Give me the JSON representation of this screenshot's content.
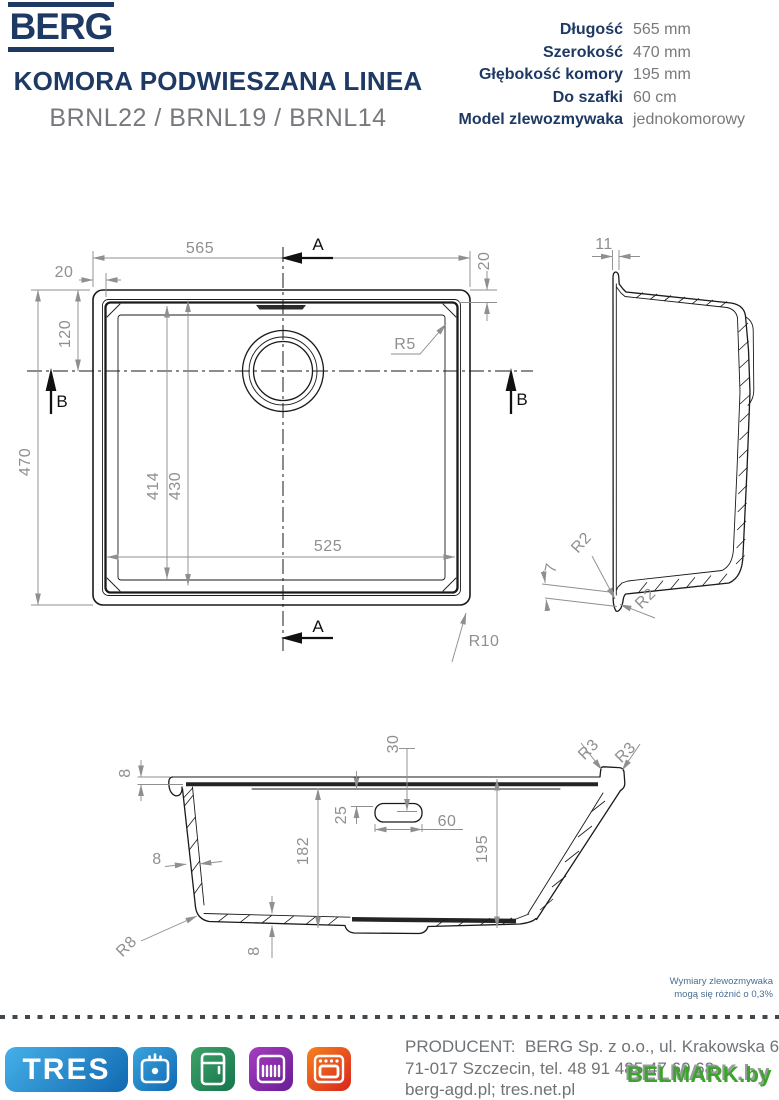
{
  "header": {
    "brand": "BERG",
    "title": "KOMORA PODWIESZANA LINEA",
    "models": "BRNL22 / BRNL19 / BRNL14",
    "specs": [
      {
        "label": "Długość",
        "value": "565 mm"
      },
      {
        "label": "Szerokość",
        "value": "470 mm"
      },
      {
        "label": "Głębokość komory",
        "value": "195 mm"
      },
      {
        "label": "Do szafki",
        "value": "60 cm"
      },
      {
        "label": "Model zlewozmywaka",
        "value": "jednokomorowy"
      }
    ]
  },
  "drawing": {
    "top_view": {
      "dim_length": "565",
      "dim_rim_left": "20",
      "dim_rim_right": "20",
      "dim_drain": "120",
      "dim_width": "470",
      "dim_inner_a": "414",
      "dim_inner_b": "430",
      "dim_inner_width": "525",
      "radius_bowl": "R5",
      "radius_outer": "R10",
      "section_a": "A",
      "section_b": "B"
    },
    "side_view": {
      "dim_top": "11",
      "dim_foot": "7",
      "radius_top": "R2",
      "radius_bottom": "R2"
    },
    "cross_section": {
      "dim_rim": "8",
      "dim_wall": "8",
      "dim_inner_depth": "182",
      "dim_overflow_top": "25",
      "dim_overflow_pos": "30",
      "dim_overflow_width": "60",
      "dim_depth": "195",
      "dim_bottom": "8",
      "radius_corner": "R8",
      "radius_edge_a": "R3",
      "radius_edge_b": "R3"
    },
    "note_line1": "Wymiary zlewozmywaka",
    "note_line2": "mogą się różnić o 0,3%"
  },
  "footer": {
    "tres": "TRES",
    "icons": [
      "sink-icon",
      "fridge-icon",
      "dishwasher-icon",
      "oven-icon"
    ],
    "producer_line1": "PRODUCENT:  BERG Sp. z o.o., ul. Krakowska 61B,",
    "producer_line2": "71-017 Szczecin, tel. 48 91 485 47 60 68",
    "producer_line3": "berg-agd.pl; tres.net.pl",
    "watermark": "BELMARK.by"
  },
  "colors": {
    "navy": "#1e3a64",
    "text-gray": "#77797c",
    "producer-gray": "#6f7377",
    "dim-gray": "#8f8f8f",
    "line-black": "#1a1a1a",
    "note-blue": "#4a6d94",
    "tres-blue-1": "#45b0e8",
    "tres-blue-2": "#1168b0",
    "sink-blue-1": "#3ba4de",
    "sink-blue-2": "#1069b2",
    "fridge-green-1": "#3fa269",
    "fridge-green-2": "#14764b",
    "dw-purple-1": "#a53ec0",
    "dw-purple-2": "#6a1b96",
    "oven-orange-1": "#f5821f",
    "oven-orange-2": "#d9251d",
    "watermark-green": "#3ca32c"
  }
}
